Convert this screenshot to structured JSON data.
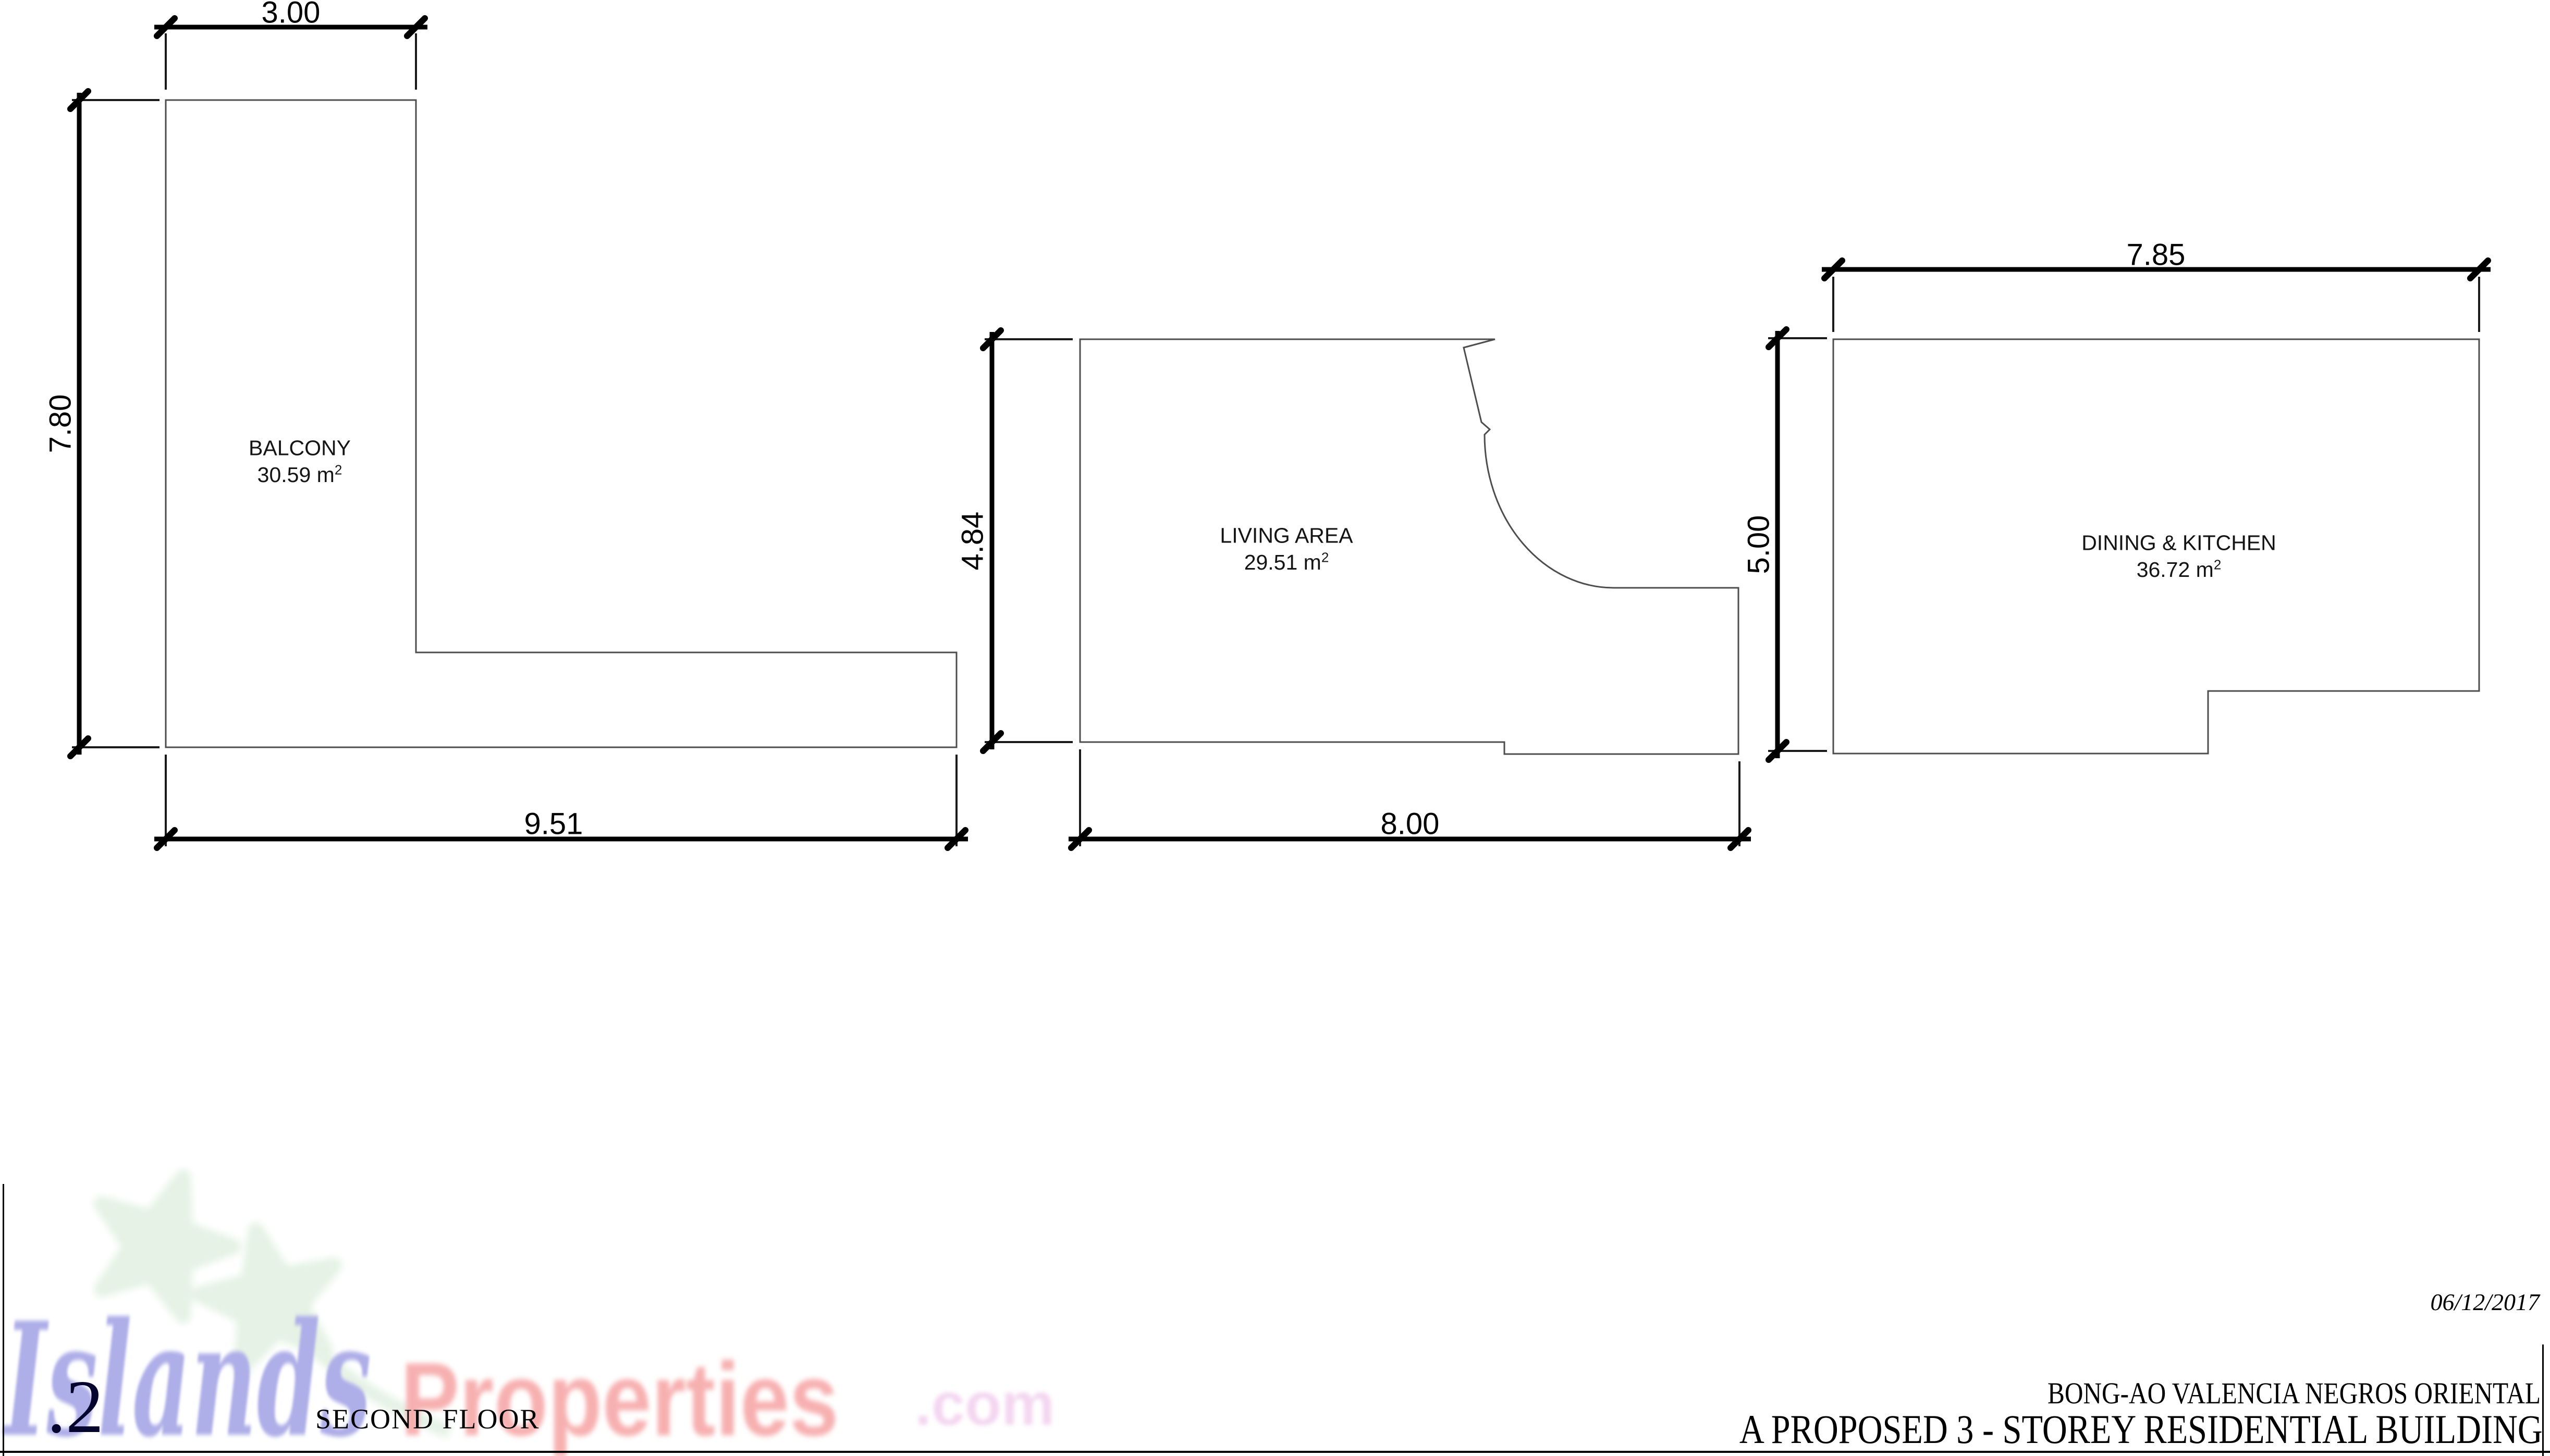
{
  "title_block": {
    "date": "06/12/2017",
    "location": "BONG-AO VALENCIA NEGROS ORIENTAL",
    "project": "A PROPOSED 3 - STOREY RESIDENTIAL BUILDING",
    "sheet_number": ".2",
    "floor": "SECOND FLOOR"
  },
  "watermark": {
    "part_islands": "Islands",
    "part_properties": "Properties",
    "part_com": ".com"
  },
  "rooms": [
    {
      "name": "BALCONY",
      "area": "30.59 m",
      "area_sup": "2"
    },
    {
      "name": "LIVING AREA",
      "area": "29.51 m",
      "area_sup": "2"
    },
    {
      "name": "DINING & KITCHEN",
      "area": "36.72 m",
      "area_sup": "2"
    }
  ],
  "dimensions": {
    "balcony_width": "3.00",
    "balcony_height": "7.80",
    "balcony_length": "9.51",
    "living_height": "4.84",
    "living_width": "8.00",
    "dining_height": "5.00",
    "dining_width": "7.85"
  },
  "colors": {
    "watermark_islands": "#aeaee8",
    "watermark_properties": "#f7b0b0",
    "watermark_com": "#f3d6f0",
    "watermark_palm": "#e5f2e5",
    "sheet_number_ink": "#05052e",
    "wall_line": "#4d4d4d",
    "dimension_ink": "#000000"
  }
}
